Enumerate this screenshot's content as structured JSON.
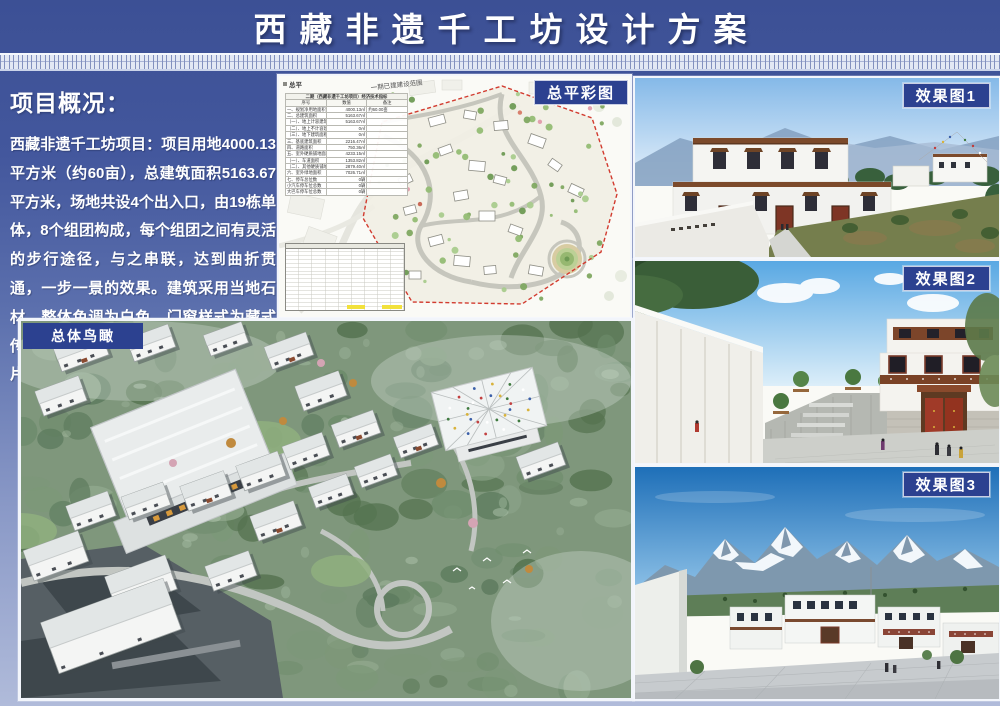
{
  "header": {
    "title": "西藏非遗千工坊设计方案"
  },
  "overview": {
    "heading": "项目概况：",
    "body": "西藏非遗千工坊项目：项目用地4000.13平方米（约60亩），总建筑面积5163.67平方米，场地共设4个出入口，由19栋单体，8个组团构成，每个组团之间有灵活的步行途径，与之串联，达到曲折贯通，一步一景的效果。建筑采用当地石材，整体色调为白色，门窗样式为藏式传统样式，有着浓厚的藏式风味，符合片区的整体风貌。"
  },
  "panels": {
    "site_plan": {
      "label": "总平彩图",
      "corner_note": "总平",
      "range_note": "一期已建建设范围",
      "indicator_table": {
        "title": "二期（西藏非遗千工坊项目）经济技术指标",
        "headers": [
          "序号",
          "数值",
          "备注"
        ],
        "rows": [
          [
            "一、规划净用地面积",
            "4000.13㎡",
            "约60.00亩"
          ],
          [
            "二、总建筑面积",
            "5163.67㎡",
            ""
          ],
          [
            "（一）、地上计容建筑面积",
            "5163.67㎡",
            ""
          ],
          [
            "（二）、地上不计容建筑面积",
            "0㎡",
            ""
          ],
          [
            "（三）、地下建筑面积",
            "0㎡",
            ""
          ],
          [
            "三、基底建筑面积",
            "2216.47㎡",
            ""
          ],
          [
            "四、道路面积",
            "750.36㎡",
            ""
          ],
          [
            "五、室外硬质铺地面积",
            "4233.15㎡",
            ""
          ],
          [
            "（一）、车道面积",
            "1353.82㎡",
            ""
          ],
          [
            "（二）、其他硬质铺地面积",
            "2879.40㎡",
            ""
          ],
          [
            "六、室外绿地面积",
            "7026.71㎡",
            ""
          ],
          [
            "七、停车总位数",
            "0辆",
            ""
          ],
          [
            "小汽车停车位总数",
            "0辆",
            ""
          ],
          [
            "大巴车停车位总数",
            "0辆",
            ""
          ]
        ]
      }
    },
    "aerial": {
      "label": "总体鸟瞰"
    },
    "render1": {
      "label": "效果图1"
    },
    "render2": {
      "label": "效果图2"
    },
    "render3": {
      "label": "效果图3"
    }
  },
  "colors": {
    "accent_blue": "#2C4190",
    "boundary_red": "#D23B2F",
    "highlight_yellow": "#F2E13C",
    "background_top": "#3C5095",
    "background_bottom": "#B0BBDA"
  }
}
